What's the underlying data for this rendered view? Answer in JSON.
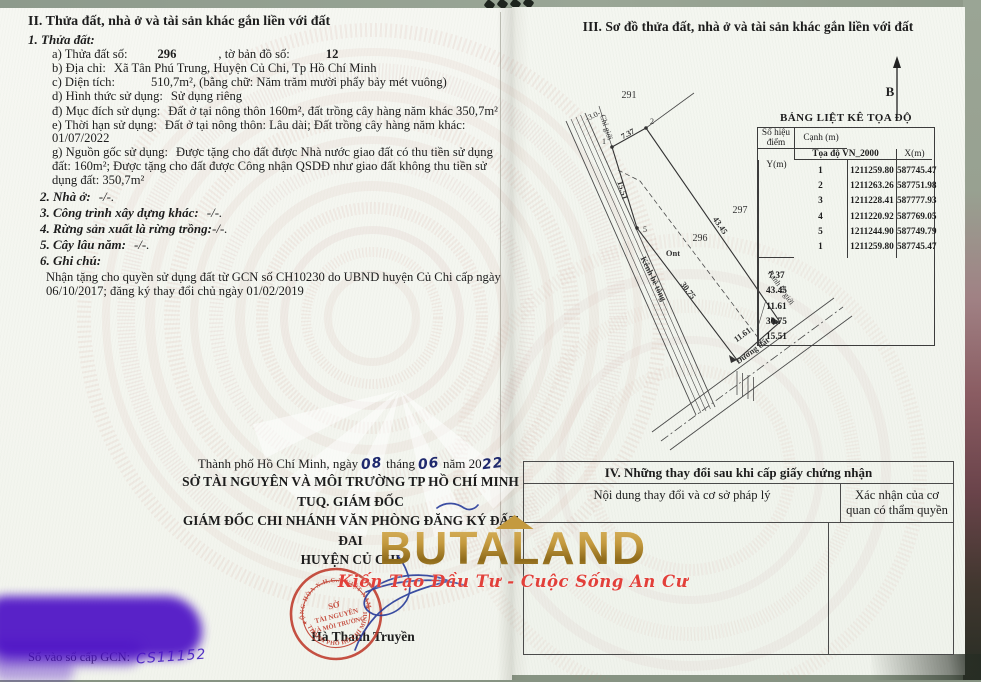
{
  "colors": {
    "stamp_red": "#bf3a2b",
    "ink_blue": "#2b3f9b",
    "redaction_purple": "#4e13c6",
    "logo_gold": "#c49a3f",
    "tagline_red": "#e2403a"
  },
  "left": {
    "s2_title": "II. Thửa đất, nhà ở và tài sản khác gắn liền với đất",
    "s2": {
      "sub1": "1. Thửa đất:",
      "a": {
        "label": "a) Thửa đất số:",
        "v1": "296",
        "label2": ", tờ bản đồ số:",
        "v2": "12"
      },
      "b": {
        "label": "b) Địa chỉ:",
        "v": "Xã Tân Phú Trung, Huyện Củ Chi, Tp Hồ Chí Minh"
      },
      "c": {
        "label": "c) Diện tích:",
        "v": "510,7m²",
        "suffix": ", (bằng chữ: Năm trăm mười phẩy bảy mét vuông)"
      },
      "d": {
        "label": "d) Hình thức sử dụng:",
        "v": "Sử dụng riêng"
      },
      "dd": {
        "label": "đ) Mục đích sử dụng:",
        "v": "Đất ở tại nông thôn 160m², đất trồng cây hàng năm khác 350,7m²"
      },
      "e": {
        "label": "e) Thời hạn sử dụng:",
        "v": "Đất ở tại nông thôn: Lâu dài; Đất trồng cây hàng năm khác:",
        "v2": "01/07/2022"
      },
      "g": {
        "label": "g) Nguồn gốc sử dụng:",
        "v": "Được tặng cho đất được Nhà nước giao đất có thu tiền sử dụng đất: 160m²; Được tặng cho đất được Công nhận QSDĐ như giao đất không thu tiền sử dụng đất: 350,7m²"
      },
      "i2": {
        "label": "2. Nhà ở:",
        "v": "-/-."
      },
      "i3": {
        "label": "3. Công trình xây dựng khác:",
        "v": "-/-."
      },
      "i4": {
        "label": "4. Rừng sản xuất là rừng trồng:",
        "v": "-/-."
      },
      "i5": {
        "label": "5. Cây lâu năm:",
        "v": "-/-."
      },
      "i6": {
        "label": "6. Ghi chú:"
      },
      "note": "Nhận tặng cho quyền sử dụng đất từ GCN số CH10230 do UBND huyện Củ Chi cấp ngày 06/10/2017; đăng ký thay đổi chủ ngày  01/02/2019"
    },
    "sign": {
      "date_prefix": "Thành phố Hồ Chí Minh, ngày",
      "day": "08",
      "thang": "tháng",
      "month": "06",
      "nam": "năm 20",
      "year": "22",
      "org1": "SỞ TÀI NGUYÊN VÀ MÔI TRƯỜNG TP HỒ CHÍ MINH",
      "org2": "TUQ. GIÁM ĐỐC",
      "org3": "GIÁM ĐỐC CHI NHÁNH VĂN PHÒNG ĐĂNG KÝ ĐẤT ĐAI",
      "org4": "HUYỆN CỦ CHI",
      "signer": "Hà Thanh Truyền"
    },
    "stamp": {
      "arc_top": "CỘNG HÒA X.H.C.N VIỆT NAM",
      "arc_bottom": "THÀNH PHỐ HỒ CHÍ MINH",
      "center1": "SỞ",
      "center2": "TÀI NGUYÊN",
      "center3": "VÀ MÔI TRƯỜNG",
      "star": "★"
    },
    "serial": {
      "label": "Số vào sổ cấp GCN:",
      "value": "CS11152"
    }
  },
  "right": {
    "s3_title": "III. Sơ đồ thửa đất, nhà ở và tài sản khác gắn liền với đất",
    "north": "B",
    "map": {
      "p291": "291",
      "p297": "297",
      "p296": "296",
      "ont": "Ont",
      "e12": "7.37",
      "e23": "43.45",
      "e34": "11.61",
      "e45": "30.75",
      "e51": "15.51",
      "w": "-3.0-",
      "chigioi": "Chỉ giới",
      "kenh": "Kênh bê tông",
      "ranh": "Ranh lộ giới",
      "duong": "Đường đất",
      "n1": "1",
      "n2": "2",
      "n5": "5"
    },
    "coord": {
      "title": "BẢNG LIỆT KÊ TỌA ĐỘ",
      "h_point": "Số hiệu điểm",
      "h_coord": "Tọa độ VN_2000",
      "h_x": "X(m)",
      "h_y": "Y(m)",
      "h_edge": "Cạnh (m)",
      "rows": [
        [
          "1",
          "1211259.80",
          "587745.47"
        ],
        [
          "2",
          "1211263.26",
          "587751.98"
        ],
        [
          "3",
          "1211228.41",
          "587777.93"
        ],
        [
          "4",
          "1211220.92",
          "587769.05"
        ],
        [
          "5",
          "1211244.90",
          "587749.79"
        ],
        [
          "1",
          "1211259.80",
          "587745.47"
        ]
      ],
      "edges": [
        "7.37",
        "43.45",
        "11.61",
        "30.75",
        "15.51"
      ]
    },
    "s4": {
      "title": "IV. Những thay đổi sau khi cấp giấy chứng nhận",
      "col1": "Nội dung thay đổi và cơ sở pháp lý",
      "col2": "Xác nhận của cơ quan có thẩm quyền"
    }
  },
  "watermark": {
    "brand": "BUTALAND",
    "tagline": "Kiến Tạo Đầu Tư - Cuộc Sống An Cư"
  }
}
